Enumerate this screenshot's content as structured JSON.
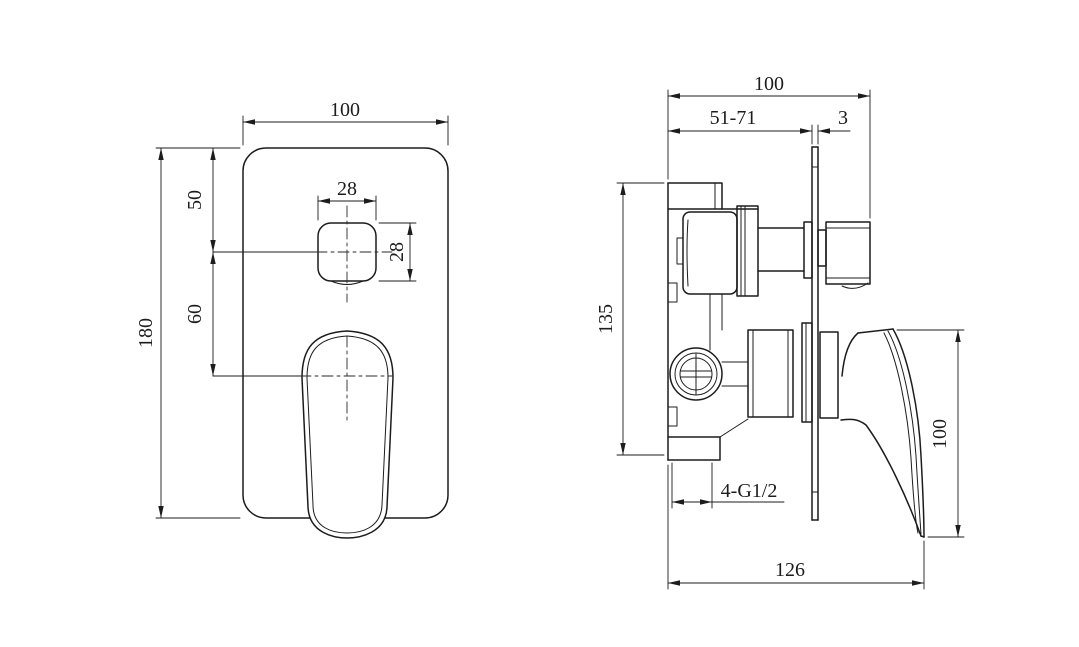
{
  "drawing": {
    "background_color": "#ffffff",
    "line_color": "#1c1c1c"
  },
  "front_view": {
    "plate_width": "100",
    "plate_height": "180",
    "button_center_from_top": "50",
    "button_to_handle_center": "60",
    "button_width": "28",
    "button_height": "28"
  },
  "side_view": {
    "overall_depth": "100",
    "installation_depth_range": "51-71",
    "faceplate_thickness": "3",
    "valve_body_height": "135",
    "handle_length": "100",
    "connection_threads": "4-G1/2",
    "overall_length": "126"
  }
}
